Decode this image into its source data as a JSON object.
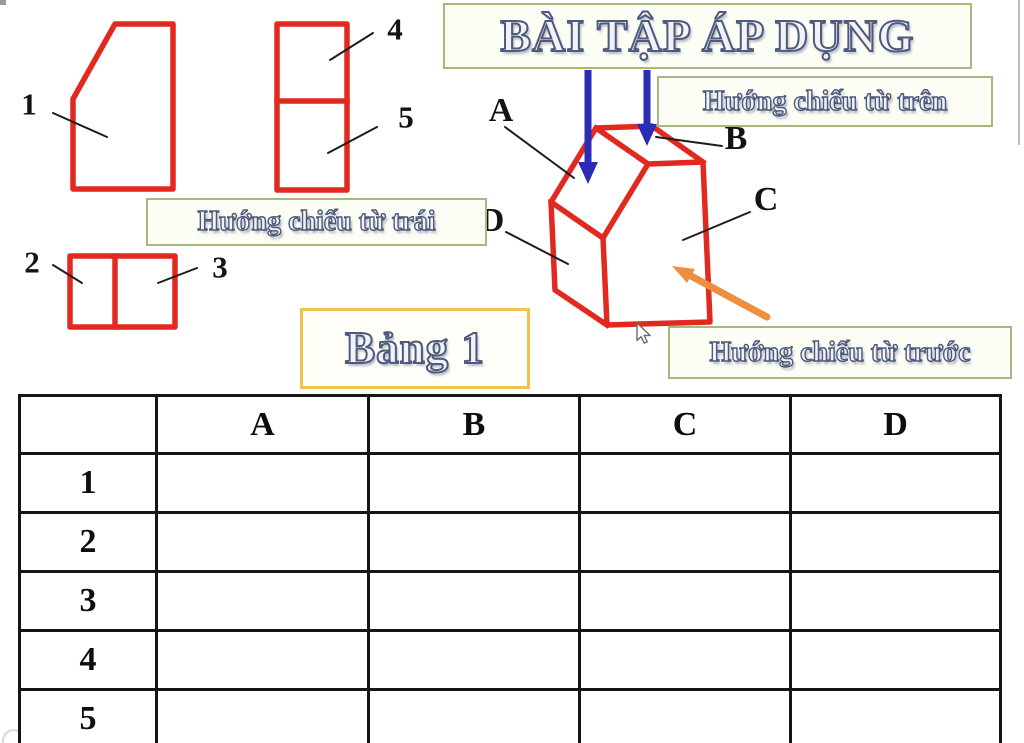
{
  "title": "BÀI TẬP ÁP DỤNG",
  "callouts": {
    "top": "Hướng chiếu từ trên",
    "left": "Hướng chiếu từ trái",
    "front": "Hướng chiếu từ trước",
    "table_caption": "Bảng 1"
  },
  "view_numbers": {
    "v1": "1",
    "v2": "2",
    "v3": "3",
    "v4": "4",
    "v5": "5"
  },
  "face_labels": {
    "a": "A",
    "b": "B",
    "c": "C",
    "d": "D"
  },
  "table": {
    "corner": "",
    "headers": [
      "A",
      "B",
      "C",
      "D"
    ],
    "rows": [
      {
        "label": "1",
        "cells": [
          "",
          "",
          "",
          ""
        ]
      },
      {
        "label": "2",
        "cells": [
          "",
          "",
          "",
          ""
        ]
      },
      {
        "label": "3",
        "cells": [
          "",
          "",
          "",
          ""
        ]
      },
      {
        "label": "4",
        "cells": [
          "",
          "",
          "",
          ""
        ]
      },
      {
        "label": "5",
        "cells": [
          "",
          "",
          "",
          ""
        ]
      }
    ]
  },
  "colors": {
    "red": "#e2291f",
    "blue": "#2b2bb4",
    "orange": "#ee8e3f",
    "green-border": "#a8b77e",
    "box-bg": "#fcfdf4",
    "yellow-border": "#f2c24e",
    "text-fill": "#f1f3f9",
    "text-stroke": "#4e5a7b",
    "table-border": "#161616",
    "label-color": "#131313"
  }
}
